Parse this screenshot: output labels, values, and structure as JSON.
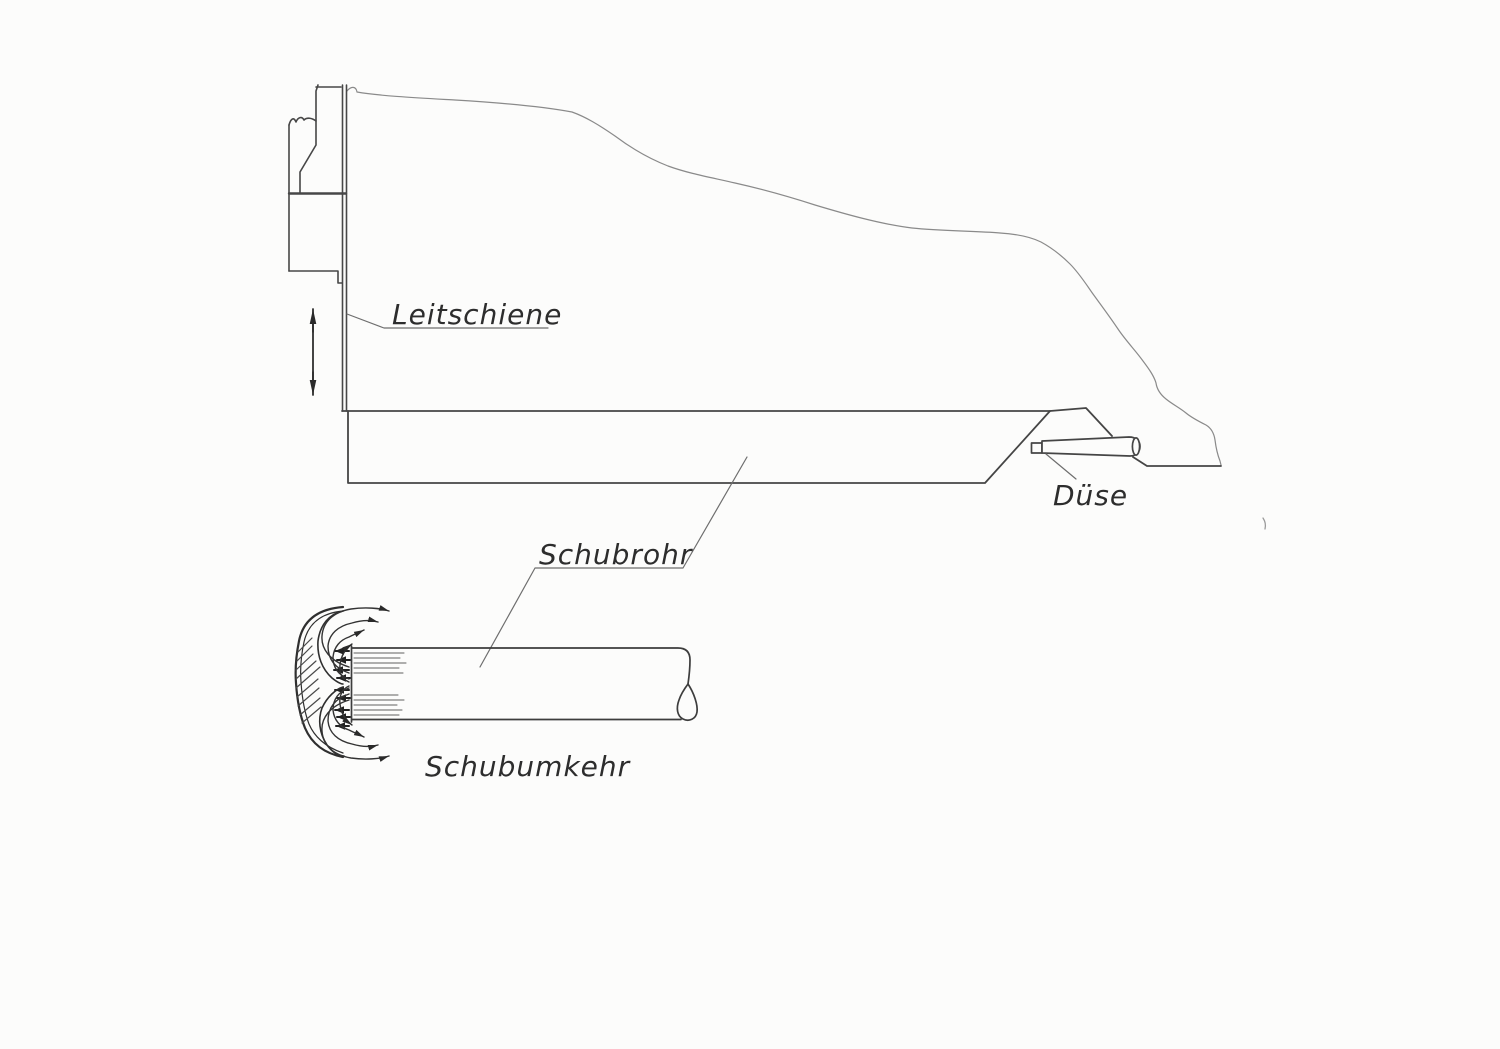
{
  "page": {
    "type": "scanned hand-drawn technical sketch of a waterjet stern arrangement with thrust reverser detail",
    "background": "#fcfcfb"
  },
  "labels": {
    "leitschiene": "Leitschiene",
    "schubrohr": "Schubrohr",
    "duese": "Düse",
    "schubumkehr": "Schubumkehr"
  },
  "icons": {
    "vertical_double_arrow": "↕",
    "reverse_flow_arrow": "←",
    "deflected_jet_arrow": "→"
  },
  "colors": {
    "pencil_dark": "#3d3d3d",
    "pencil_medium": "#5f5f5f",
    "pencil_light": "#8a8a8a",
    "arrow_ink": "#2a2a2a",
    "label_text": "#2d2d2d",
    "paper": "#fcfcfb"
  }
}
